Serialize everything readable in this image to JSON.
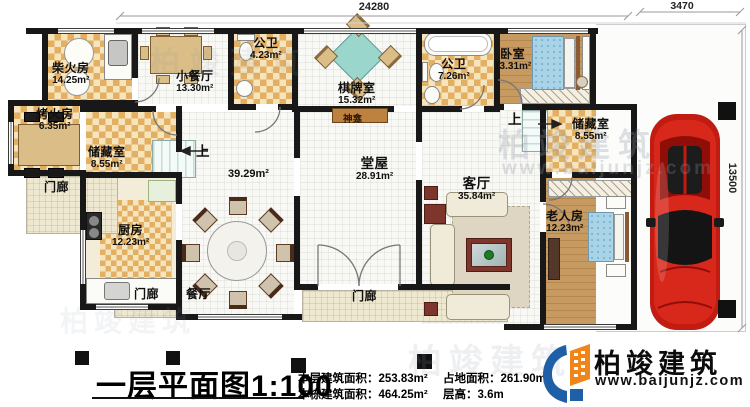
{
  "plan": {
    "rooms": {
      "chaihuofang": {
        "name": "柴火房",
        "area": "14.25m²"
      },
      "xiaocanting": {
        "name": "小餐厅",
        "area": "13.30m²"
      },
      "gongwei1": {
        "name": "公卫",
        "area": "4.23m²"
      },
      "qipaishi": {
        "name": "棋牌室",
        "area": "15.32m²"
      },
      "gongwei2": {
        "name": "公卫",
        "area": "7.26m²"
      },
      "woshi": {
        "name": "卧室",
        "area": "13.31m²"
      },
      "kaohuofang": {
        "name": "烤火房",
        "area": "6.35m²"
      },
      "chucangshi_l": {
        "name": "储藏室",
        "area": "8.55m²"
      },
      "chucangshi_r": {
        "name": "储藏室",
        "area": "8.55m²"
      },
      "chufang": {
        "name": "厨房",
        "area": "12.23m²"
      },
      "tangwu": {
        "name": "堂屋",
        "area": "28.91m²"
      },
      "keting": {
        "name": "客厅",
        "area": "35.84m²"
      },
      "laorenfang": {
        "name": "老人房",
        "area": "12.23m²"
      },
      "canting": {
        "name": "餐厅"
      },
      "menlang": {
        "name": "门廊"
      }
    },
    "labels": {
      "shang": "上",
      "shrine": "神龛",
      "hall_area": "39.29m²"
    },
    "dimensions": {
      "top": "24280",
      "top_right": "3470",
      "right": "13500"
    }
  },
  "title_block": {
    "title": "一层平面图",
    "scale": "1:100",
    "stats": [
      {
        "label": "本层建筑面积：",
        "value": "253.83m²"
      },
      {
        "label": "本栋建筑面积：",
        "value": "464.25m²"
      },
      {
        "label": "占地面积：",
        "value": "261.90m²"
      },
      {
        "label": "层高：",
        "value": "3.6m"
      }
    ]
  },
  "brand": {
    "name": "柏竣建筑",
    "website": "www.baijunjz.com"
  },
  "colors": {
    "wall": "#181818",
    "checker_floor": "#e3af63",
    "wood_floor": "#c69a61",
    "bed_blue": "#a9d3e6",
    "game_table_teal": "#9bd6cd",
    "shrine_brown": "#bd8140",
    "car_red": "#c21b12",
    "logo_blue": "#1f5fa8",
    "logo_orange": "#f08519"
  }
}
